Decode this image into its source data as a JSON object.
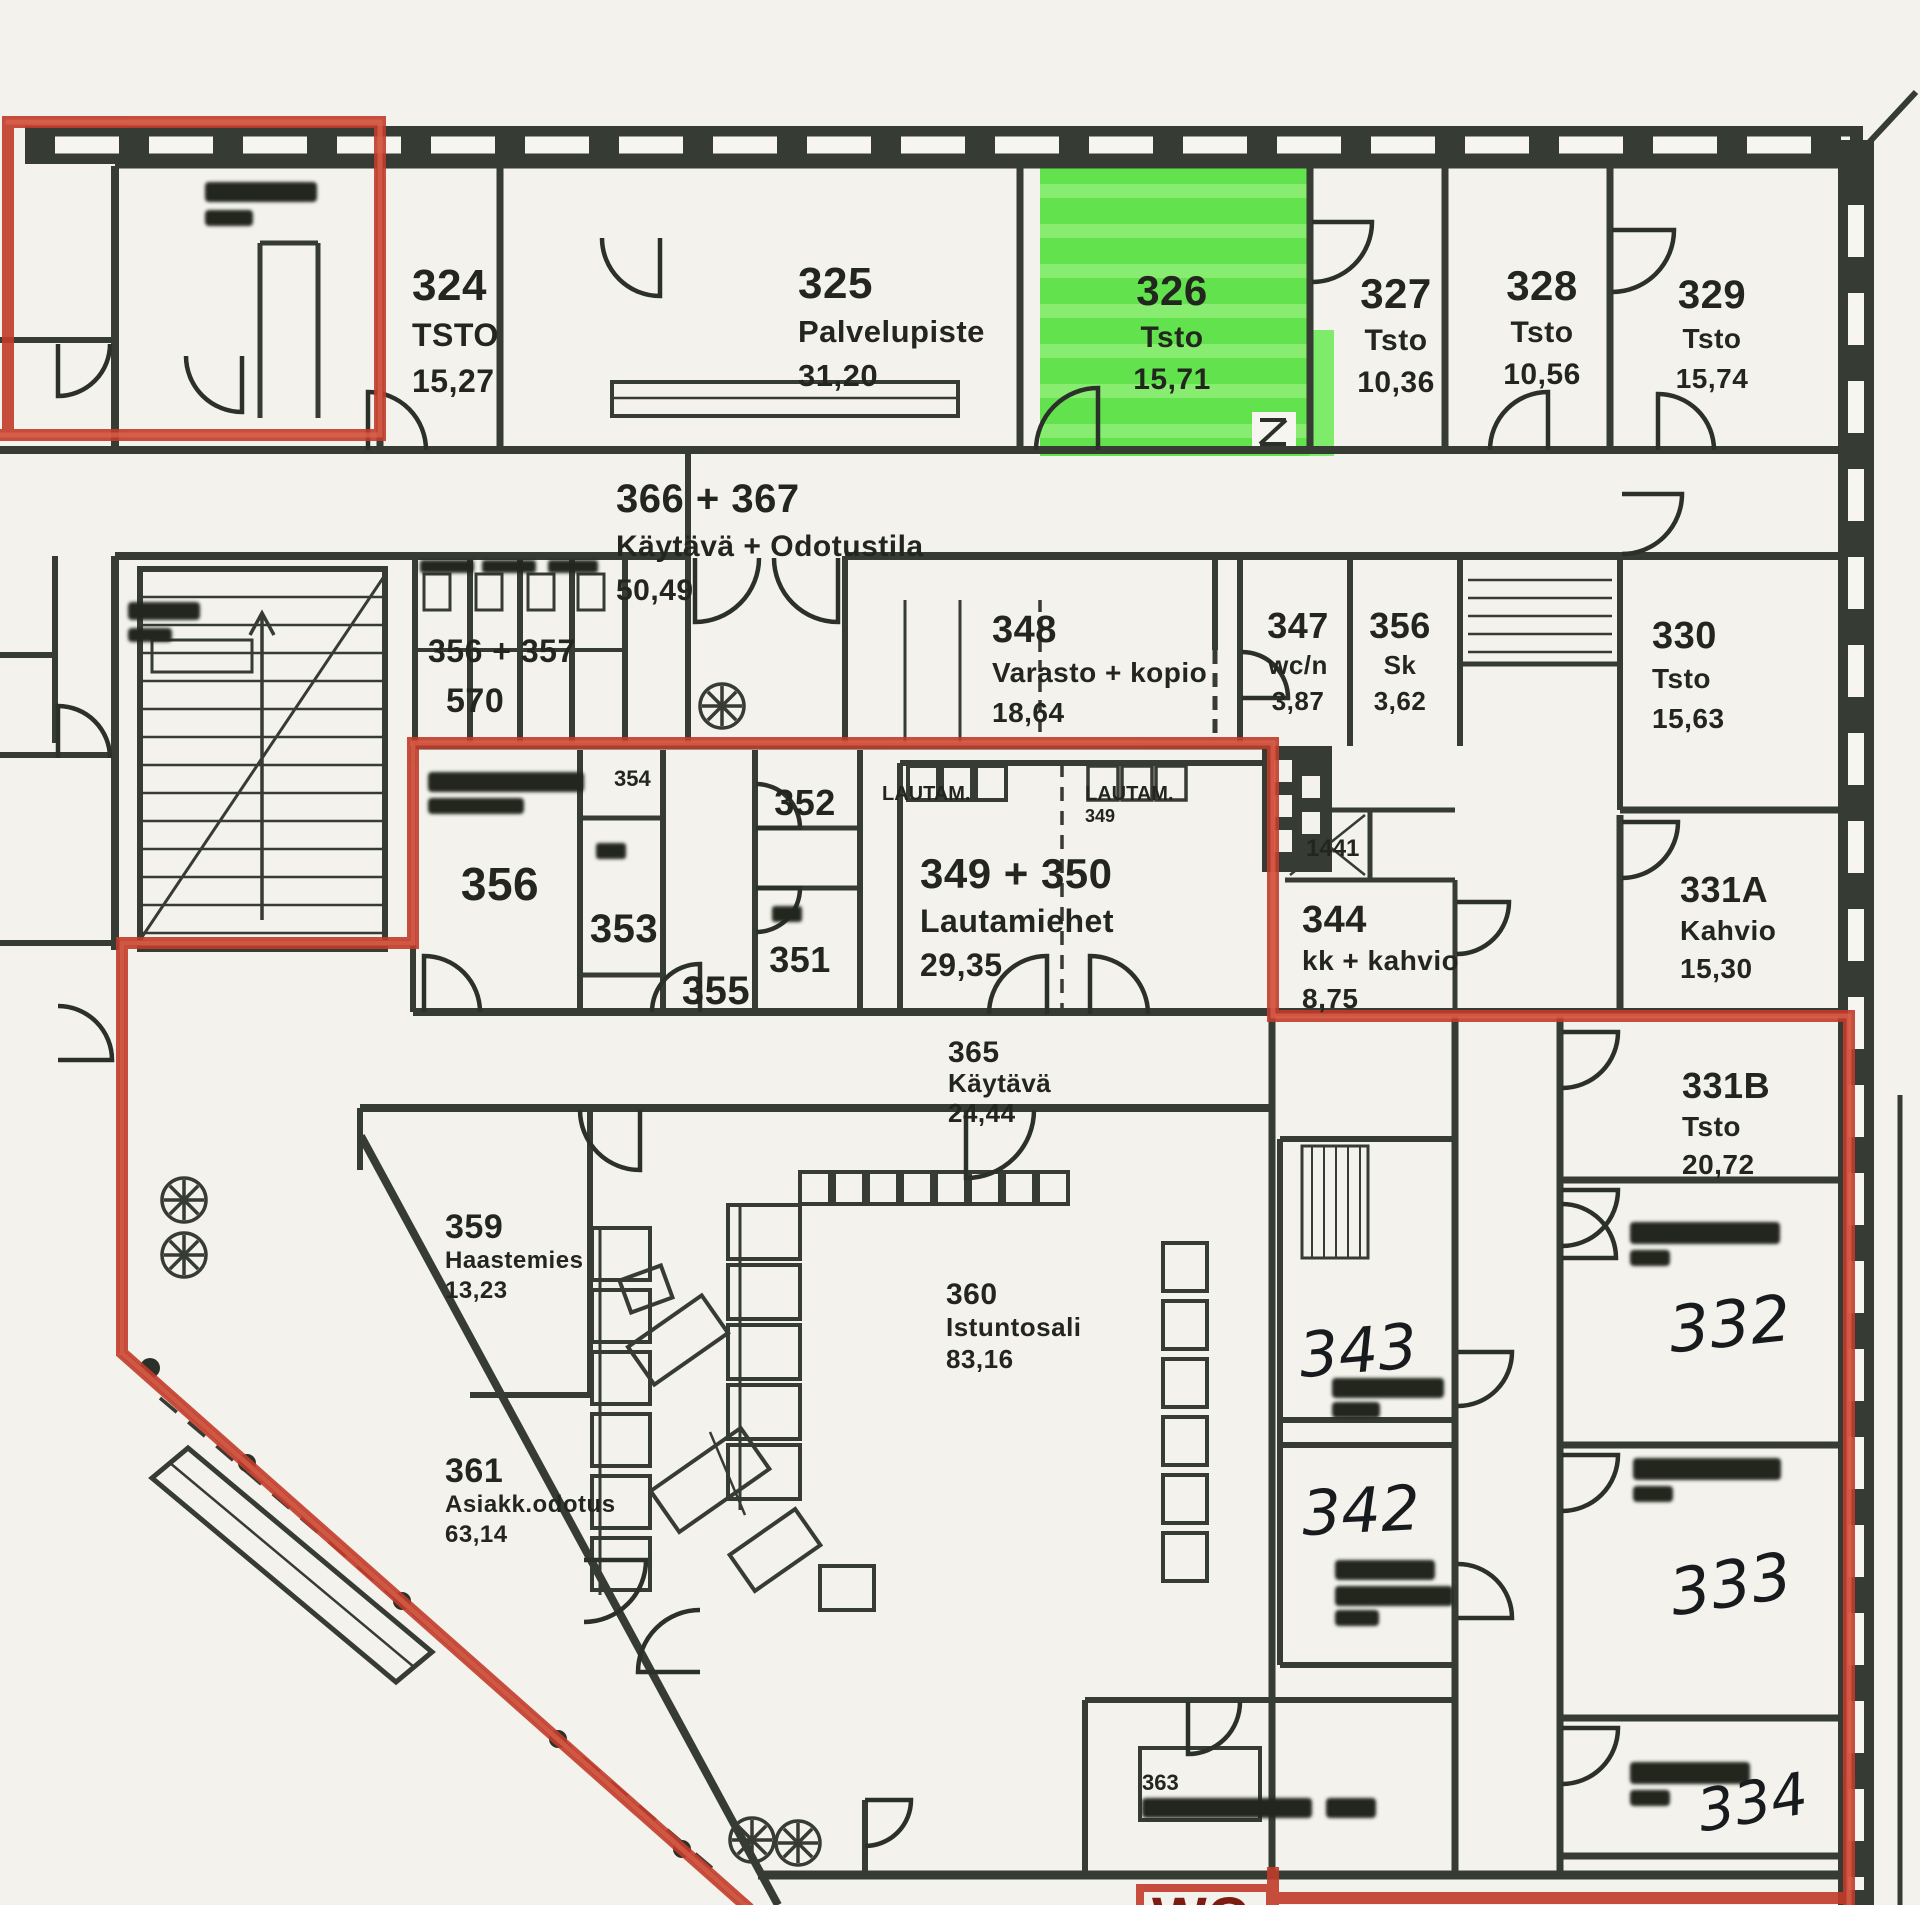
{
  "document": {
    "kind": "scanned floor plan, 3rd floor office wing",
    "language": "Finnish",
    "highlight_color": "#55e23f",
    "boundary_color": "#c23b2a",
    "wall_color": "#363b34",
    "paper_color": "#f3f2ec",
    "highlighted_room": "326"
  },
  "rooms": [
    {
      "id": "324",
      "lines": [
        "324",
        "TSTO",
        "15,27"
      ],
      "x": 412,
      "y": 300,
      "s": 44,
      "sub": 32,
      "lh": 46,
      "anchor": "s",
      "style": "printed"
    },
    {
      "id": "325",
      "lines": [
        "325",
        "Palvelupiste",
        "31,20"
      ],
      "x": 798,
      "y": 298,
      "s": 44,
      "sub": 31,
      "lh": 44,
      "anchor": "s",
      "style": "printed"
    },
    {
      "id": "326",
      "lines": [
        "326",
        "Tsto",
        "15,71"
      ],
      "x": 1172,
      "y": 305,
      "s": 42,
      "sub": 30,
      "lh": 42,
      "anchor": "m",
      "style": "printed"
    },
    {
      "id": "327",
      "lines": [
        "327",
        "Tsto",
        "10,36"
      ],
      "x": 1396,
      "y": 308,
      "s": 42,
      "sub": 30,
      "lh": 42,
      "anchor": "m",
      "style": "printed"
    },
    {
      "id": "328",
      "lines": [
        "328",
        "Tsto",
        "10,56"
      ],
      "x": 1542,
      "y": 300,
      "s": 42,
      "sub": 30,
      "lh": 42,
      "anchor": "m",
      "style": "printed"
    },
    {
      "id": "329",
      "lines": [
        "329",
        "Tsto",
        "15,74"
      ],
      "x": 1712,
      "y": 308,
      "s": 40,
      "sub": 28,
      "lh": 40,
      "anchor": "m",
      "style": "printed"
    },
    {
      "id": "366-367",
      "lines": [
        "366 + 367",
        "Käytävä + Odotustila",
        "50,49"
      ],
      "x": 616,
      "y": 512,
      "s": 40,
      "sub": 30,
      "lh": 44,
      "anchor": "s",
      "style": "printed"
    },
    {
      "id": "348",
      "lines": [
        "348",
        "Varasto + kopio",
        "18,64"
      ],
      "x": 992,
      "y": 642,
      "s": 38,
      "sub": 28,
      "lh": 40,
      "anchor": "s",
      "style": "printed"
    },
    {
      "id": "347",
      "lines": [
        "347",
        "wc/n",
        "3,87"
      ],
      "x": 1298,
      "y": 638,
      "s": 36,
      "sub": 26,
      "lh": 36,
      "anchor": "m",
      "style": "printed"
    },
    {
      "id": "356-sk",
      "lines": [
        "356",
        "Sk",
        "3,62"
      ],
      "x": 1400,
      "y": 638,
      "s": 36,
      "sub": 26,
      "lh": 36,
      "anchor": "m",
      "style": "printed"
    },
    {
      "id": "330",
      "lines": [
        "330",
        "Tsto",
        "15,63"
      ],
      "x": 1652,
      "y": 648,
      "s": 38,
      "sub": 28,
      "lh": 40,
      "anchor": "s",
      "style": "printed"
    },
    {
      "id": "356",
      "lines": [
        "356"
      ],
      "x": 500,
      "y": 900,
      "s": 46,
      "sub": 46,
      "lh": 46,
      "anchor": "m",
      "style": "printed"
    },
    {
      "id": "353",
      "lines": [
        "353"
      ],
      "x": 624,
      "y": 942,
      "s": 40,
      "sub": 40,
      "lh": 40,
      "anchor": "m",
      "style": "printed"
    },
    {
      "id": "352",
      "lines": [
        "352"
      ],
      "x": 805,
      "y": 815,
      "s": 36,
      "sub": 36,
      "lh": 36,
      "anchor": "m",
      "style": "printed"
    },
    {
      "id": "351",
      "lines": [
        "351"
      ],
      "x": 800,
      "y": 972,
      "s": 36,
      "sub": 36,
      "lh": 36,
      "anchor": "m",
      "style": "printed"
    },
    {
      "id": "355",
      "lines": [
        "355"
      ],
      "x": 716,
      "y": 1004,
      "s": 40,
      "sub": 40,
      "lh": 40,
      "anchor": "m",
      "style": "printed"
    },
    {
      "id": "356-357-wc",
      "lines": [
        "356 + 357"
      ],
      "x": 428,
      "y": 662,
      "s": 32,
      "sub": 32,
      "lh": 32,
      "anchor": "s",
      "style": "printed"
    },
    {
      "id": "570",
      "lines": [
        "570"
      ],
      "x": 446,
      "y": 712,
      "s": 34,
      "sub": 34,
      "lh": 34,
      "anchor": "s",
      "style": "printed"
    },
    {
      "id": "349-350",
      "lines": [
        "349 + 350",
        "Lautamiehet",
        "29,35"
      ],
      "x": 920,
      "y": 888,
      "s": 42,
      "sub": 32,
      "lh": 44,
      "anchor": "s",
      "style": "printed"
    },
    {
      "id": "344",
      "lines": [
        "344",
        "kk + kahvio",
        "8,75"
      ],
      "x": 1302,
      "y": 932,
      "s": 38,
      "sub": 28,
      "lh": 38,
      "anchor": "s",
      "style": "printed"
    },
    {
      "id": "331A",
      "lines": [
        "331A",
        "Kahvio",
        "15,30"
      ],
      "x": 1680,
      "y": 902,
      "s": 36,
      "sub": 28,
      "lh": 38,
      "anchor": "s",
      "style": "printed"
    },
    {
      "id": "331B",
      "lines": [
        "331B",
        "Tsto",
        "20,72"
      ],
      "x": 1682,
      "y": 1098,
      "s": 36,
      "sub": 28,
      "lh": 38,
      "anchor": "s",
      "style": "printed"
    },
    {
      "id": "365",
      "lines": [
        "365",
        "Käytävä",
        "24,44"
      ],
      "x": 948,
      "y": 1062,
      "s": 30,
      "sub": 26,
      "lh": 30,
      "anchor": "s",
      "style": "printed"
    },
    {
      "id": "359",
      "lines": [
        "359",
        "Haastemies",
        "13,23"
      ],
      "x": 445,
      "y": 1238,
      "s": 34,
      "sub": 24,
      "lh": 30,
      "anchor": "s",
      "style": "printed"
    },
    {
      "id": "360",
      "lines": [
        "360",
        "Istuntosali",
        "83,16"
      ],
      "x": 946,
      "y": 1304,
      "s": 30,
      "sub": 26,
      "lh": 32,
      "anchor": "s",
      "style": "printed"
    },
    {
      "id": "361",
      "lines": [
        "361",
        "Asiakk.odotus",
        "63,14"
      ],
      "x": 445,
      "y": 1482,
      "s": 34,
      "sub": 24,
      "lh": 30,
      "anchor": "s",
      "style": "printed"
    },
    {
      "id": "343",
      "lines": [
        "343"
      ],
      "x": 1360,
      "y": 1372,
      "s": 62,
      "sub": 62,
      "lh": 62,
      "anchor": "m",
      "style": "hand",
      "rot": -5
    },
    {
      "id": "342",
      "lines": [
        "342"
      ],
      "x": 1362,
      "y": 1532,
      "s": 62,
      "sub": 62,
      "lh": 62,
      "anchor": "m",
      "style": "hand",
      "rot": -3
    },
    {
      "id": "332",
      "lines": [
        "332"
      ],
      "x": 1732,
      "y": 1346,
      "s": 64,
      "sub": 64,
      "lh": 64,
      "anchor": "m",
      "style": "hand",
      "rot": -6
    },
    {
      "id": "333",
      "lines": [
        "333"
      ],
      "x": 1734,
      "y": 1606,
      "s": 64,
      "sub": 64,
      "lh": 64,
      "anchor": "m",
      "style": "hand",
      "rot": -9
    },
    {
      "id": "334",
      "lines": [
        "334"
      ],
      "x": 1756,
      "y": 1822,
      "s": 58,
      "sub": 58,
      "lh": 58,
      "anchor": "m",
      "style": "hand",
      "rot": -10
    }
  ],
  "tiny_labels": [
    {
      "id": "lautam-left",
      "text": "LAUTAM.",
      "x": 882,
      "y": 800,
      "s": 20,
      "anchor": "s"
    },
    {
      "id": "lautam-right",
      "text": "LAUTAM.",
      "x": 1085,
      "y": 800,
      "s": 20,
      "anchor": "s"
    },
    {
      "id": "lautam-right-num",
      "text": "349",
      "x": 1085,
      "y": 822,
      "s": 18,
      "anchor": "s"
    },
    {
      "id": "num-1441",
      "text": "1441",
      "x": 1306,
      "y": 856,
      "s": 24,
      "anchor": "s"
    },
    {
      "id": "num-363",
      "text": "363",
      "x": 1142,
      "y": 1790,
      "s": 22,
      "anchor": "s"
    },
    {
      "id": "num-354",
      "text": "354",
      "x": 614,
      "y": 786,
      "s": 22,
      "anchor": "s"
    }
  ],
  "extras": {
    "wc_label": "WC"
  }
}
